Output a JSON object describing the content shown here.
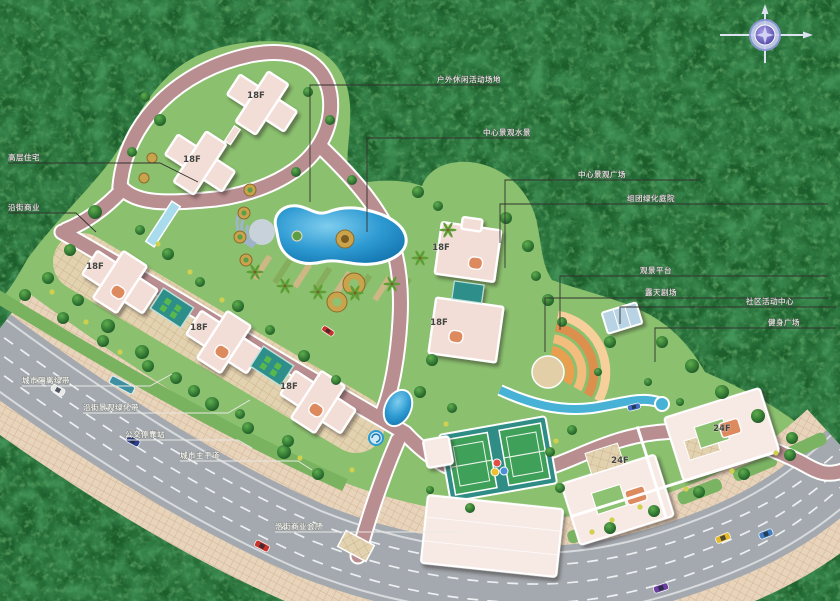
{
  "meta": {
    "title": "residential community master plan (aerial rendering)",
    "phase_note": "site plan with labeled amenities and tower heights"
  },
  "colors": {
    "forest_base": "#1c5f2c",
    "lawn": "#8ac06e",
    "city_road": "#a3a9ae",
    "road_line": "#eef0f2",
    "sidewalk": "#e8d3bb",
    "site_road": "#b98e90",
    "building": "#f3ddd7",
    "pool": "#2e9ad2",
    "pool_light": "#6cc4ea",
    "terrace_orange": "#e8a050",
    "court_pad": "#2f8d86",
    "label_gray": "#d6dad3",
    "label_white": "#f2f2ee",
    "leader": "#32322e",
    "compass": "#8a7fd6"
  },
  "compass": {
    "icon": "compass-rose",
    "letters_visible": ""
  },
  "floor_tags": [
    {
      "label": "18F"
    },
    {
      "label": "18F"
    },
    {
      "label": "18F"
    },
    {
      "label": "18F"
    },
    {
      "label": "18F"
    },
    {
      "label": "18F"
    },
    {
      "label": "18F"
    },
    {
      "label": "24F"
    },
    {
      "label": "24F"
    }
  ],
  "annotations": [
    {
      "id": "outdoor-activity-area",
      "text": "户外休闲活动场地"
    },
    {
      "id": "central-water-feature",
      "text": "中心景观水景"
    },
    {
      "id": "central-plaza",
      "text": "中心景观广场"
    },
    {
      "id": "cluster-courtyard",
      "text": "组团绿化庭院"
    },
    {
      "id": "view-terrace",
      "text": "观景平台"
    },
    {
      "id": "open-air-theater",
      "text": "露天剧场"
    },
    {
      "id": "community-center",
      "text": "社区活动中心"
    },
    {
      "id": "fitness-plaza",
      "text": "健身广场"
    },
    {
      "id": "highrise-residence",
      "text": "高层住宅"
    },
    {
      "id": "street-retail",
      "text": "沿街商业"
    },
    {
      "id": "green-buffer",
      "text": "城市隔离绿带"
    },
    {
      "id": "street-planting",
      "text": "沿街景观绿化带"
    },
    {
      "id": "bus-stop",
      "text": "公交停靠站"
    },
    {
      "id": "city-main-road",
      "text": "城市主干道"
    },
    {
      "id": "retail-clubhouse",
      "text": "沿街商业会所"
    }
  ],
  "vehicles": [
    {
      "color": "#c9332b",
      "x": 262,
      "y": 546,
      "angle": 28,
      "w": 15,
      "h": 7
    },
    {
      "color": "#c9332b",
      "x": 328,
      "y": 331,
      "angle": 33,
      "w": 13,
      "h": 6
    },
    {
      "color": "#2b3f8f",
      "x": 133,
      "y": 441,
      "angle": 28,
      "w": 14,
      "h": 7
    },
    {
      "color": "#e8e8e8",
      "x": 58,
      "y": 390,
      "angle": 28,
      "w": 14,
      "h": 7
    },
    {
      "color": "#e3b92e",
      "x": 723,
      "y": 538,
      "angle": -22,
      "w": 15,
      "h": 7
    },
    {
      "color": "#3f7fc4",
      "x": 766,
      "y": 534,
      "angle": -22,
      "w": 14,
      "h": 7
    },
    {
      "color": "#6a3f9e",
      "x": 661,
      "y": 588,
      "angle": -18,
      "w": 15,
      "h": 7
    },
    {
      "color": "#3f6fc4",
      "x": 634,
      "y": 407,
      "angle": -14,
      "w": 13,
      "h": 6
    }
  ]
}
